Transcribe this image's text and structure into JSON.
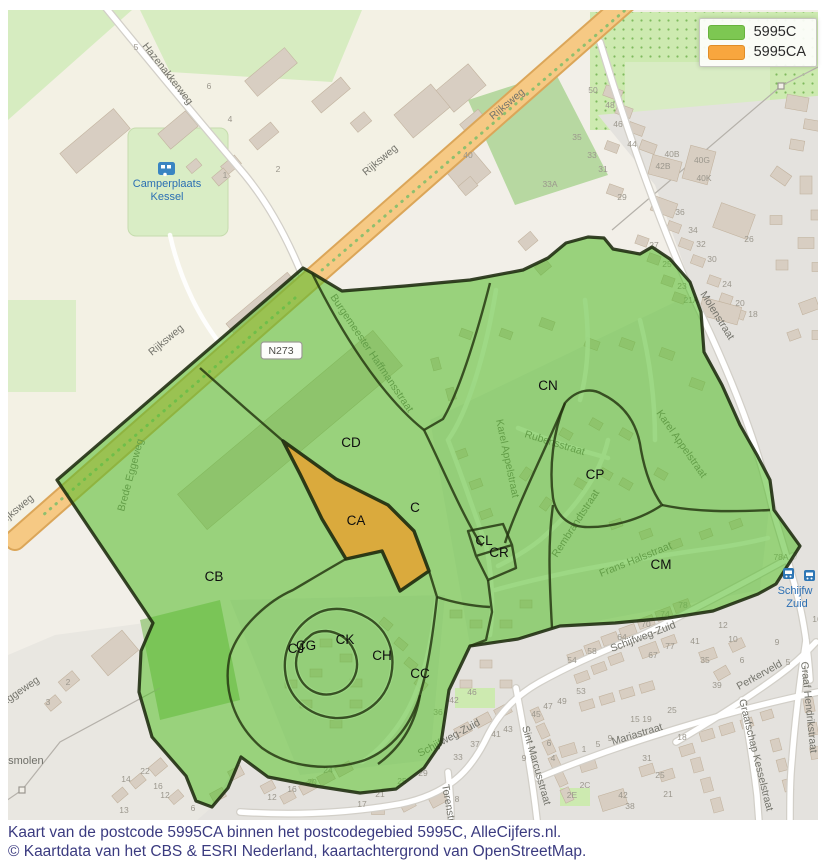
{
  "legend": {
    "items": [
      {
        "label": "5995C",
        "color": "#7dc752",
        "border": "#68b23c"
      },
      {
        "label": "5995CA",
        "color": "#f8a63e",
        "border": "#e08d26"
      }
    ]
  },
  "caption": {
    "line1": "Kaart van de postcode 5995CA binnen het postcodegebied 5995C, AlleCijfers.nl.",
    "line2": "© Kaartdata van het CBS & ESRI Nederland, kaartachtergrond van OpenStreetMap."
  },
  "map": {
    "road_badge": {
      "t": "N273",
      "x": 281,
      "y": 353
    },
    "area_labels": [
      {
        "t": "C",
        "x": 415,
        "y": 512
      },
      {
        "t": "CA",
        "x": 356,
        "y": 525
      },
      {
        "t": "CB",
        "x": 214,
        "y": 581
      },
      {
        "t": "CC",
        "x": 420,
        "y": 678
      },
      {
        "t": "CD",
        "x": 351,
        "y": 447
      },
      {
        "t": "CJ",
        "x": 296,
        "y": 653
      },
      {
        "t": "CG",
        "x": 306,
        "y": 650
      },
      {
        "t": "CH",
        "x": 382,
        "y": 660
      },
      {
        "t": "CK",
        "x": 345,
        "y": 644
      },
      {
        "t": "CL",
        "x": 484,
        "y": 545
      },
      {
        "t": "CM",
        "x": 661,
        "y": 569
      },
      {
        "t": "CN",
        "x": 548,
        "y": 390
      },
      {
        "t": "CP",
        "x": 595,
        "y": 479
      },
      {
        "t": "CR",
        "x": 499,
        "y": 557
      }
    ],
    "street_labels": [
      {
        "t": "Hazenakkerweg",
        "x": 142,
        "y": 46,
        "r": 52,
        "s": 11
      },
      {
        "t": "Rijksweg",
        "x": 493,
        "y": 120,
        "r": -40,
        "s": 11
      },
      {
        "t": "Rijksweg",
        "x": 366,
        "y": 176,
        "r": -40,
        "s": 10.5
      },
      {
        "t": "Rijksweg",
        "x": 152,
        "y": 356,
        "r": -40,
        "s": 10.5
      },
      {
        "t": "Rijksweg",
        "x": 2,
        "y": 526,
        "r": -40,
        "s": 10.5
      },
      {
        "t": "Molenstraat",
        "x": 700,
        "y": 294,
        "r": 58,
        "s": 11
      },
      {
        "t": "Burgemeester Haffmansstraat",
        "x": 330,
        "y": 297,
        "r": 56,
        "s": 9.5
      },
      {
        "t": "Karel Appelstraat",
        "x": 496,
        "y": 420,
        "r": 78,
        "s": 10
      },
      {
        "t": "Karel Appelstraat",
        "x": 656,
        "y": 413,
        "r": 55,
        "s": 10
      },
      {
        "t": "Rubensstraat",
        "x": 524,
        "y": 437,
        "r": 17,
        "s": 10
      },
      {
        "t": "Rembrandtstraat",
        "x": 557,
        "y": 558,
        "r": -57,
        "s": 10
      },
      {
        "t": "Frans Halsstraat",
        "x": 601,
        "y": 577,
        "r": -22,
        "s": 10
      },
      {
        "t": "Schijfweg-Zuid",
        "x": 612,
        "y": 652,
        "r": -21,
        "s": 11
      },
      {
        "t": "Schijfweg-Zuid",
        "x": 420,
        "y": 757,
        "r": -28,
        "s": 11
      },
      {
        "t": "Sint Marcusstraat",
        "x": 522,
        "y": 727,
        "r": 74,
        "s": 10
      },
      {
        "t": "Mariastraat",
        "x": 613,
        "y": 745,
        "r": -17,
        "s": 11
      },
      {
        "t": "Torenstraat",
        "x": 442,
        "y": 785,
        "r": 80,
        "s": 10
      },
      {
        "t": "Perkerveld",
        "x": 739,
        "y": 690,
        "r": -29,
        "s": 10.5
      },
      {
        "t": "Graaf Hendrikstraat",
        "x": 801,
        "y": 662,
        "r": 84,
        "s": 10
      },
      {
        "t": "Graafschap Kesselstraat",
        "x": 739,
        "y": 700,
        "r": 76,
        "s": 10
      },
      {
        "t": "Oude Eggeweg",
        "x": -20,
        "y": 722,
        "r": -34,
        "s": 10
      },
      {
        "t": "Brede Eggeweg",
        "x": 124,
        "y": 512,
        "r": -75,
        "s": 9.5
      }
    ],
    "poi_labels": [
      {
        "t": "Camperplaats",
        "x": 167,
        "y": 187,
        "c": "poi-blue"
      },
      {
        "t": "Kessel",
        "x": 167,
        "y": 200,
        "c": "poi-blue"
      },
      {
        "t": "usmolen",
        "x": 2,
        "y": 764,
        "c": "poi-gray"
      },
      {
        "t": "Schijfw",
        "x": 795,
        "y": 594,
        "c": "poi-blue-left"
      },
      {
        "t": "Zuid",
        "x": 797,
        "y": 607,
        "c": "poi-blue-left"
      }
    ],
    "house_numbers": [
      {
        "t": "50",
        "x": 593,
        "y": 93
      },
      {
        "t": "48",
        "x": 610,
        "y": 108
      },
      {
        "t": "46",
        "x": 618,
        "y": 127
      },
      {
        "t": "44",
        "x": 632,
        "y": 147
      },
      {
        "t": "40B",
        "x": 672,
        "y": 157
      },
      {
        "t": "42B",
        "x": 663,
        "y": 169
      },
      {
        "t": "40G",
        "x": 702,
        "y": 163
      },
      {
        "t": "40K",
        "x": 704,
        "y": 181
      },
      {
        "t": "36",
        "x": 680,
        "y": 215
      },
      {
        "t": "34",
        "x": 693,
        "y": 233
      },
      {
        "t": "32",
        "x": 701,
        "y": 247
      },
      {
        "t": "30",
        "x": 712,
        "y": 262
      },
      {
        "t": "29",
        "x": 622,
        "y": 200
      },
      {
        "t": "27",
        "x": 654,
        "y": 248
      },
      {
        "t": "25",
        "x": 667,
        "y": 267
      },
      {
        "t": "23",
        "x": 682,
        "y": 289
      },
      {
        "t": "21A",
        "x": 691,
        "y": 303
      },
      {
        "t": "26",
        "x": 749,
        "y": 242
      },
      {
        "t": "24",
        "x": 727,
        "y": 287
      },
      {
        "t": "20",
        "x": 740,
        "y": 306
      },
      {
        "t": "18",
        "x": 753,
        "y": 317
      },
      {
        "t": "35",
        "x": 577,
        "y": 140
      },
      {
        "t": "33",
        "x": 592,
        "y": 158
      },
      {
        "t": "31",
        "x": 603,
        "y": 172
      },
      {
        "t": "33A",
        "x": 550,
        "y": 187
      },
      {
        "t": "40",
        "x": 468,
        "y": 158
      },
      {
        "t": "78A",
        "x": 781,
        "y": 560
      },
      {
        "t": "16",
        "x": 817,
        "y": 622
      },
      {
        "t": "9",
        "x": 777,
        "y": 645
      },
      {
        "t": "5",
        "x": 788,
        "y": 665
      },
      {
        "t": "78",
        "x": 683,
        "y": 608
      },
      {
        "t": "74",
        "x": 665,
        "y": 617
      },
      {
        "t": "70",
        "x": 646,
        "y": 627
      },
      {
        "t": "64",
        "x": 622,
        "y": 640
      },
      {
        "t": "58",
        "x": 592,
        "y": 654
      },
      {
        "t": "54",
        "x": 572,
        "y": 663
      },
      {
        "t": "12",
        "x": 723,
        "y": 628
      },
      {
        "t": "10",
        "x": 733,
        "y": 642
      },
      {
        "t": "6",
        "x": 742,
        "y": 663
      },
      {
        "t": "41",
        "x": 695,
        "y": 644
      },
      {
        "t": "35",
        "x": 705,
        "y": 663
      },
      {
        "t": "39",
        "x": 717,
        "y": 688
      },
      {
        "t": "77",
        "x": 670,
        "y": 649
      },
      {
        "t": "67",
        "x": 653,
        "y": 658
      },
      {
        "t": "36",
        "x": 438,
        "y": 715
      },
      {
        "t": "42",
        "x": 454,
        "y": 703
      },
      {
        "t": "46",
        "x": 472,
        "y": 695
      },
      {
        "t": "53",
        "x": 581,
        "y": 694
      },
      {
        "t": "45",
        "x": 536,
        "y": 717
      },
      {
        "t": "47",
        "x": 548,
        "y": 709
      },
      {
        "t": "49",
        "x": 562,
        "y": 704
      },
      {
        "t": "37",
        "x": 475,
        "y": 747
      },
      {
        "t": "41",
        "x": 496,
        "y": 737
      },
      {
        "t": "43",
        "x": 508,
        "y": 732
      },
      {
        "t": "33",
        "x": 458,
        "y": 760
      },
      {
        "t": "29",
        "x": 423,
        "y": 776
      },
      {
        "t": "25",
        "x": 402,
        "y": 784
      },
      {
        "t": "9",
        "x": 524,
        "y": 761
      },
      {
        "t": "6",
        "x": 549,
        "y": 746
      },
      {
        "t": "4",
        "x": 553,
        "y": 761
      },
      {
        "t": "1",
        "x": 584,
        "y": 752
      },
      {
        "t": "5",
        "x": 598,
        "y": 747
      },
      {
        "t": "9",
        "x": 610,
        "y": 741
      },
      {
        "t": "15",
        "x": 635,
        "y": 722
      },
      {
        "t": "19",
        "x": 647,
        "y": 722
      },
      {
        "t": "25",
        "x": 672,
        "y": 713
      },
      {
        "t": "2E",
        "x": 572,
        "y": 798
      },
      {
        "t": "2C",
        "x": 585,
        "y": 788
      },
      {
        "t": "42",
        "x": 623,
        "y": 798
      },
      {
        "t": "38",
        "x": 630,
        "y": 809
      },
      {
        "t": "31",
        "x": 647,
        "y": 761
      },
      {
        "t": "25",
        "x": 660,
        "y": 778
      },
      {
        "t": "21",
        "x": 668,
        "y": 797
      },
      {
        "t": "18",
        "x": 682,
        "y": 740
      },
      {
        "t": "24",
        "x": 328,
        "y": 773
      },
      {
        "t": "20",
        "x": 312,
        "y": 785
      },
      {
        "t": "16",
        "x": 292,
        "y": 792
      },
      {
        "t": "12",
        "x": 272,
        "y": 800
      },
      {
        "t": "21",
        "x": 380,
        "y": 797
      },
      {
        "t": "17",
        "x": 362,
        "y": 807
      },
      {
        "t": "8",
        "x": 457,
        "y": 802
      },
      {
        "t": "2",
        "x": 68,
        "y": 685
      },
      {
        "t": "3",
        "x": 48,
        "y": 705
      },
      {
        "t": "22",
        "x": 145,
        "y": 774
      },
      {
        "t": "14",
        "x": 126,
        "y": 782
      },
      {
        "t": "16",
        "x": 158,
        "y": 789
      },
      {
        "t": "12",
        "x": 165,
        "y": 798
      },
      {
        "t": "13",
        "x": 124,
        "y": 813
      },
      {
        "t": "6",
        "x": 193,
        "y": 811
      },
      {
        "t": "5",
        "x": 136,
        "y": 50
      },
      {
        "t": "6",
        "x": 209,
        "y": 89
      },
      {
        "t": "4",
        "x": 230,
        "y": 122
      },
      {
        "t": "2",
        "x": 278,
        "y": 172
      },
      {
        "t": "1",
        "x": 225,
        "y": 178
      }
    ]
  }
}
